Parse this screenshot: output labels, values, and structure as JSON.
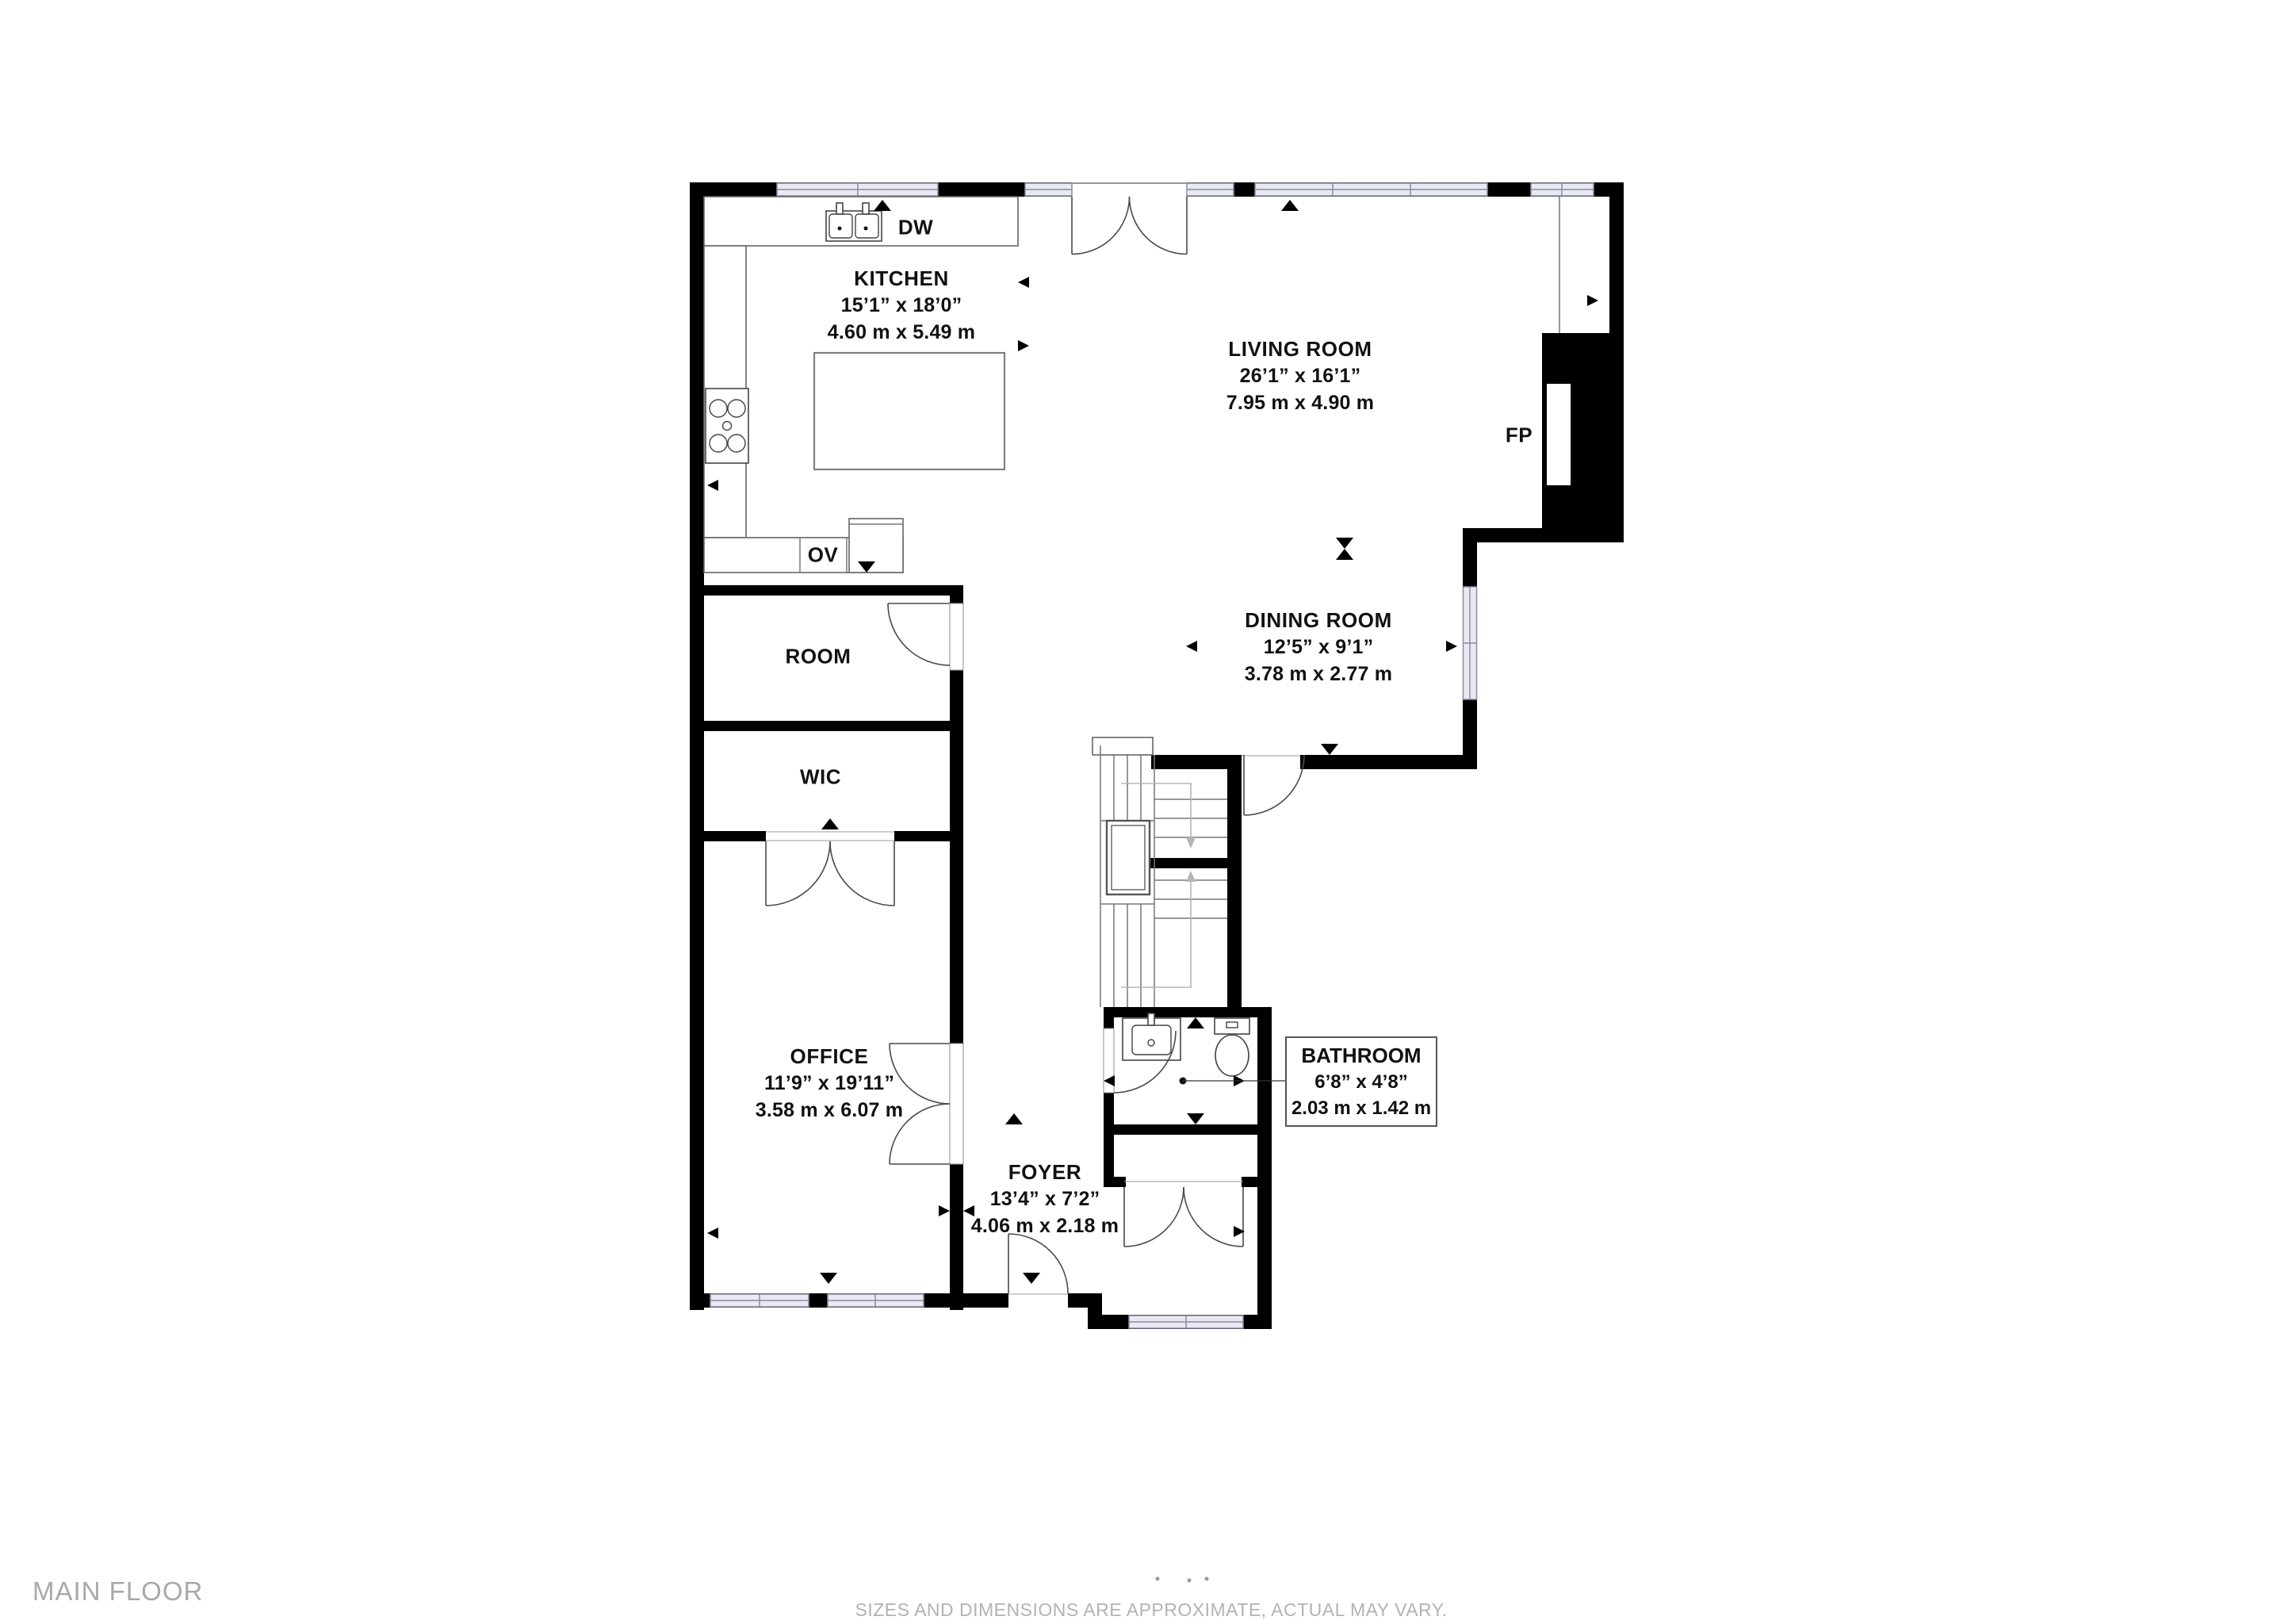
{
  "title": "MAIN FLOOR",
  "disclaimer": "SIZES AND DIMENSIONS ARE APPROXIMATE, ACTUAL MAY VARY.",
  "rooms": {
    "kitchen": {
      "name": "KITCHEN",
      "size_imperial": "15’1” x 18’0”",
      "size_metric": "4.60 m x 5.49 m"
    },
    "living_room": {
      "name": "LIVING ROOM",
      "size_imperial": "26’1” x 16’1”",
      "size_metric": "7.95 m x 4.90 m"
    },
    "dining_room": {
      "name": "DINING ROOM",
      "size_imperial": "12’5” x 9’1”",
      "size_metric": "3.78 m x 2.77 m"
    },
    "room": {
      "name": "ROOM"
    },
    "wic": {
      "name": "WIC"
    },
    "office": {
      "name": "OFFICE",
      "size_imperial": "11’9” x 19’11”",
      "size_metric": "3.58 m x 6.07 m"
    },
    "foyer": {
      "name": "FOYER",
      "size_imperial": "13’4” x 7’2”",
      "size_metric": "4.06 m x 2.18 m"
    },
    "bathroom": {
      "name": "BATHROOM",
      "size_imperial": "6’8” x 4’8”",
      "size_metric": "2.03 m x 1.42 m"
    }
  },
  "labels": {
    "dishwasher": "DW",
    "oven": "OV",
    "fireplace": "FP"
  },
  "colors": {
    "wall": "#000000",
    "window_fill": "#e9e9f4",
    "window_stroke": "#8b8ba0",
    "line": "#666666",
    "stair_guide": "#b5b5b5",
    "label_text": "#111111",
    "muted_text": "#a8a8a8",
    "disclaimer_text": "#b3b3b3"
  }
}
